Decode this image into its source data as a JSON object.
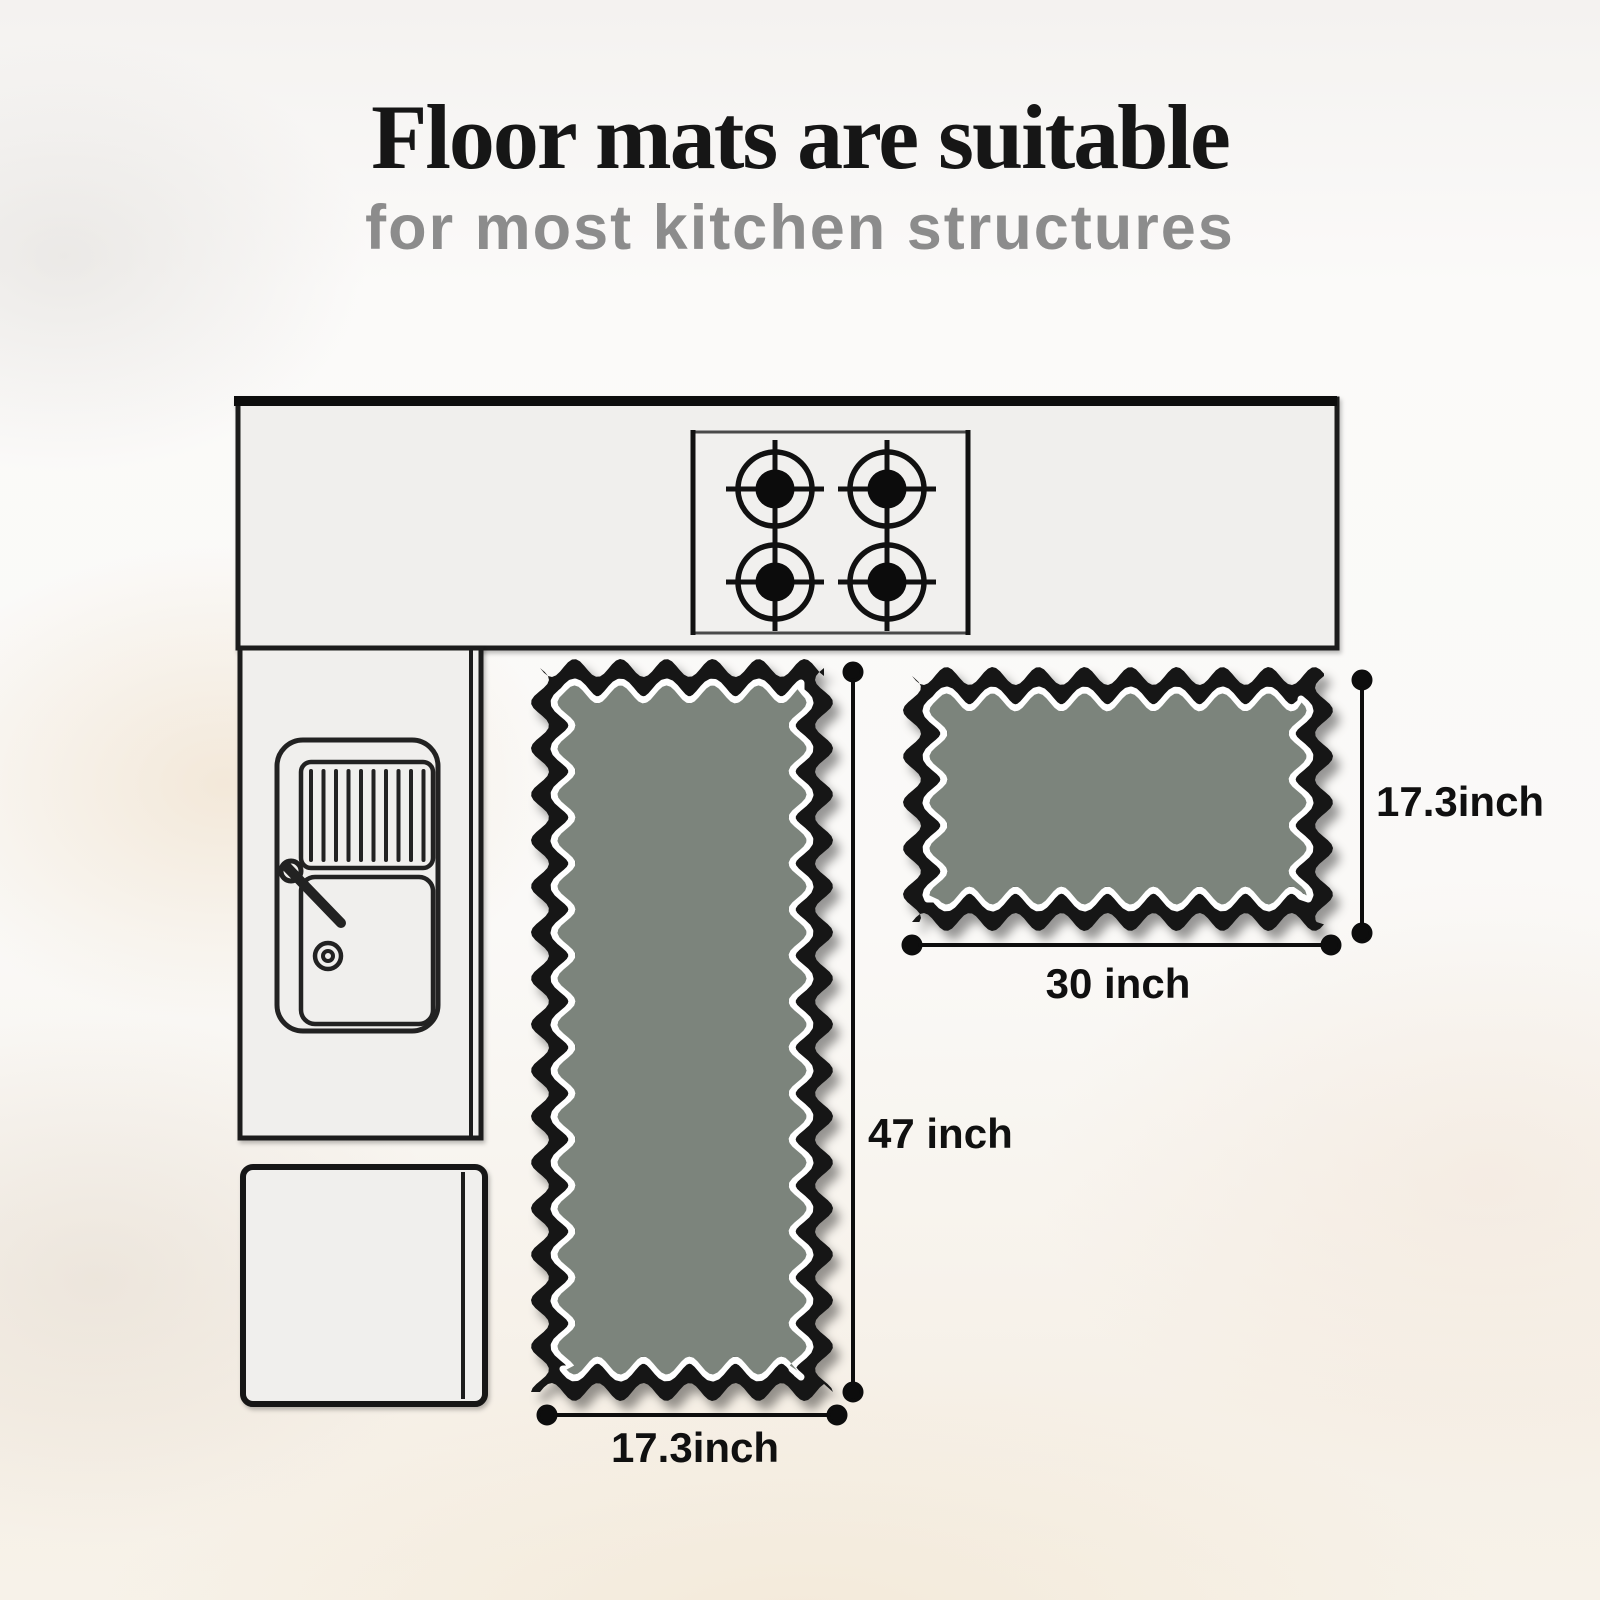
{
  "header": {
    "title": "Floor mats are suitable",
    "subtitle": "for most kitchen structures"
  },
  "colors": {
    "title_text": "#161616",
    "subtitle_text": "#8c8c8c",
    "mat_fill": "#7c847c",
    "mat_border": "#141414",
    "mat_inner_stripe": "#ffffff",
    "outline": "#1b1b1b",
    "counter_fill": "#f0efed"
  },
  "diagram": {
    "icons": {
      "stove": "stove-burners-icon",
      "sink": "sink-icon",
      "counter": "counter-outline-icon",
      "cabinet": "cabinet-outline-icon",
      "fridge": "fridge-outline-icon"
    },
    "dimensions": {
      "runner_width": "17.3inch",
      "runner_height": "47 inch",
      "small_width": "30 inch",
      "small_height": "17.3inch"
    }
  }
}
